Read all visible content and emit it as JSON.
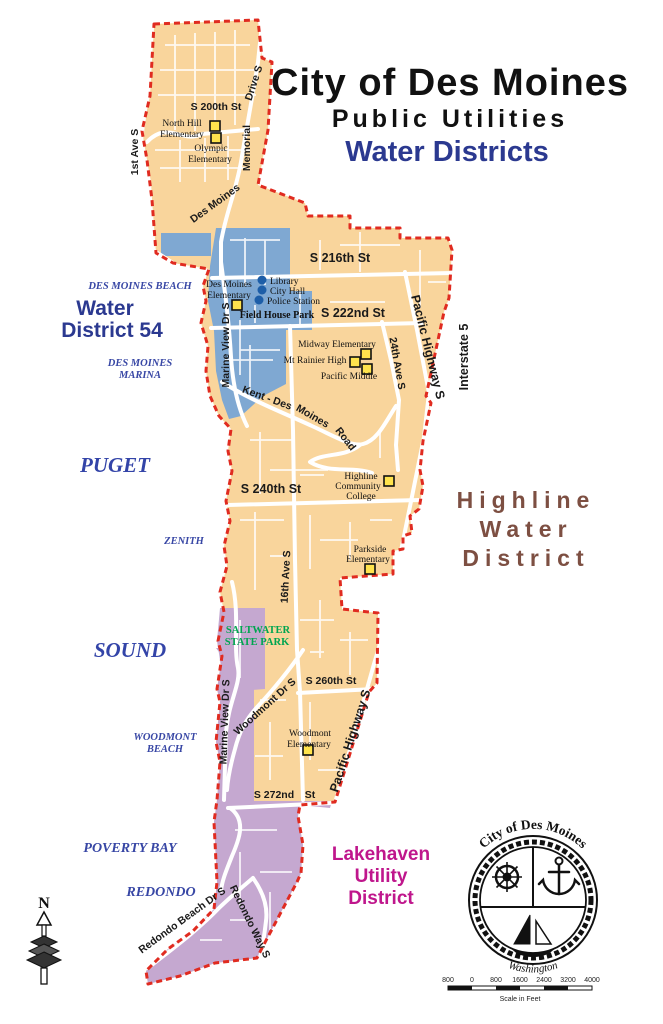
{
  "title": {
    "line1": "City of Des Moines",
    "line2": "Public Utilities",
    "line3": "Water Districts"
  },
  "colors": {
    "highline_fill": "#F9D59C",
    "wd54_fill": "#7FA8D2",
    "lakehaven_fill": "#C5A8D0",
    "boundary_red": "#E02B20",
    "wd54_text": "#2B3990",
    "highline_text": "#7D4F42",
    "lakehaven_text": "#BF168C",
    "park_text": "#00A550",
    "water_text": "#3847A5",
    "school_marker": "#FFE34D",
    "poi_marker": "#1D5EA8"
  },
  "district_labels": {
    "wd54_l1": "Water",
    "wd54_l2": "District 54",
    "highline_l1": "Highline",
    "highline_l2": "Water",
    "highline_l3": "District",
    "lakehaven_l1": "Lakehaven",
    "lakehaven_l2": "Utility",
    "lakehaven_l3": "District"
  },
  "water_labels": {
    "puget": "PUGET",
    "sound": "SOUND",
    "des_moines_beach": "DES MOINES BEACH",
    "marina_l1": "DES MOINES",
    "marina_l2": "MARINA",
    "zenith": "ZENITH",
    "woodmont_beach_l1": "WOODMONT",
    "woodmont_beach_l2": "BEACH",
    "poverty_bay": "POVERTY BAY",
    "redondo": "REDONDO"
  },
  "park_labels": {
    "saltwater_l1": "SALTWATER",
    "saltwater_l2": "STATE PARK"
  },
  "streets": {
    "first_ave_s": "1st Ave S",
    "s_200th": "S 200th St",
    "drive_s": "Drive S",
    "memorial": "Memorial",
    "des_moines": "Des Moines",
    "s_216th": "S 216th St",
    "s_222nd": "S 222nd St",
    "pacific_hwy_n": "Pacific Highway S",
    "interstate_5": "Interstate 5",
    "ave_24th": "24th Ave S",
    "kent": "Kent - Des",
    "moines": "Moines",
    "road": "Road",
    "marine_view_n": "Marine View Dr S",
    "s_240th": "S 240th St",
    "ave_16th": "16th Ave S",
    "s_260th": "S 260th St",
    "woodmont_dr": "Woodmont Dr S",
    "marine_view_s": "Marine View Dr S",
    "s_272nd": "S 272nd",
    "s_272nd_st": "St",
    "pacific_hwy_s": "Pacific Highway S",
    "redondo_beach_dr": "Redondo Beach Dr S",
    "redondo_way": "Redondo Way S"
  },
  "places": {
    "north_hill_l1": "North Hill",
    "north_hill_l2": "Elementary",
    "olympic_l1": "Olympic",
    "olympic_l2": "Elementary",
    "dm_elem_l1": "Des Moines",
    "dm_elem_l2": "Elementary",
    "library": "Library",
    "city_hall": "City Hall",
    "police": "Police Station",
    "field_house": "Field House Park",
    "midway": "Midway Elementary",
    "mt_rainier": "Mt Rainier High",
    "pacific_middle": "Pacific Middle",
    "hcc_l1": "Highline",
    "hcc_l2": "Community",
    "hcc_l3": "College",
    "parkside_l1": "Parkside",
    "parkside_l2": "Elementary",
    "woodmont_l1": "Woodmont",
    "woodmont_l2": "Elementary"
  },
  "seal": {
    "arc_top": "City of Des Moines",
    "arc_bottom": "Washington"
  },
  "compass": {
    "label": "N"
  },
  "scale_bar": {
    "ticks": [
      "800",
      "0",
      "800",
      "1600",
      "2400",
      "3200",
      "4000"
    ],
    "caption": "Scale in Feet"
  }
}
